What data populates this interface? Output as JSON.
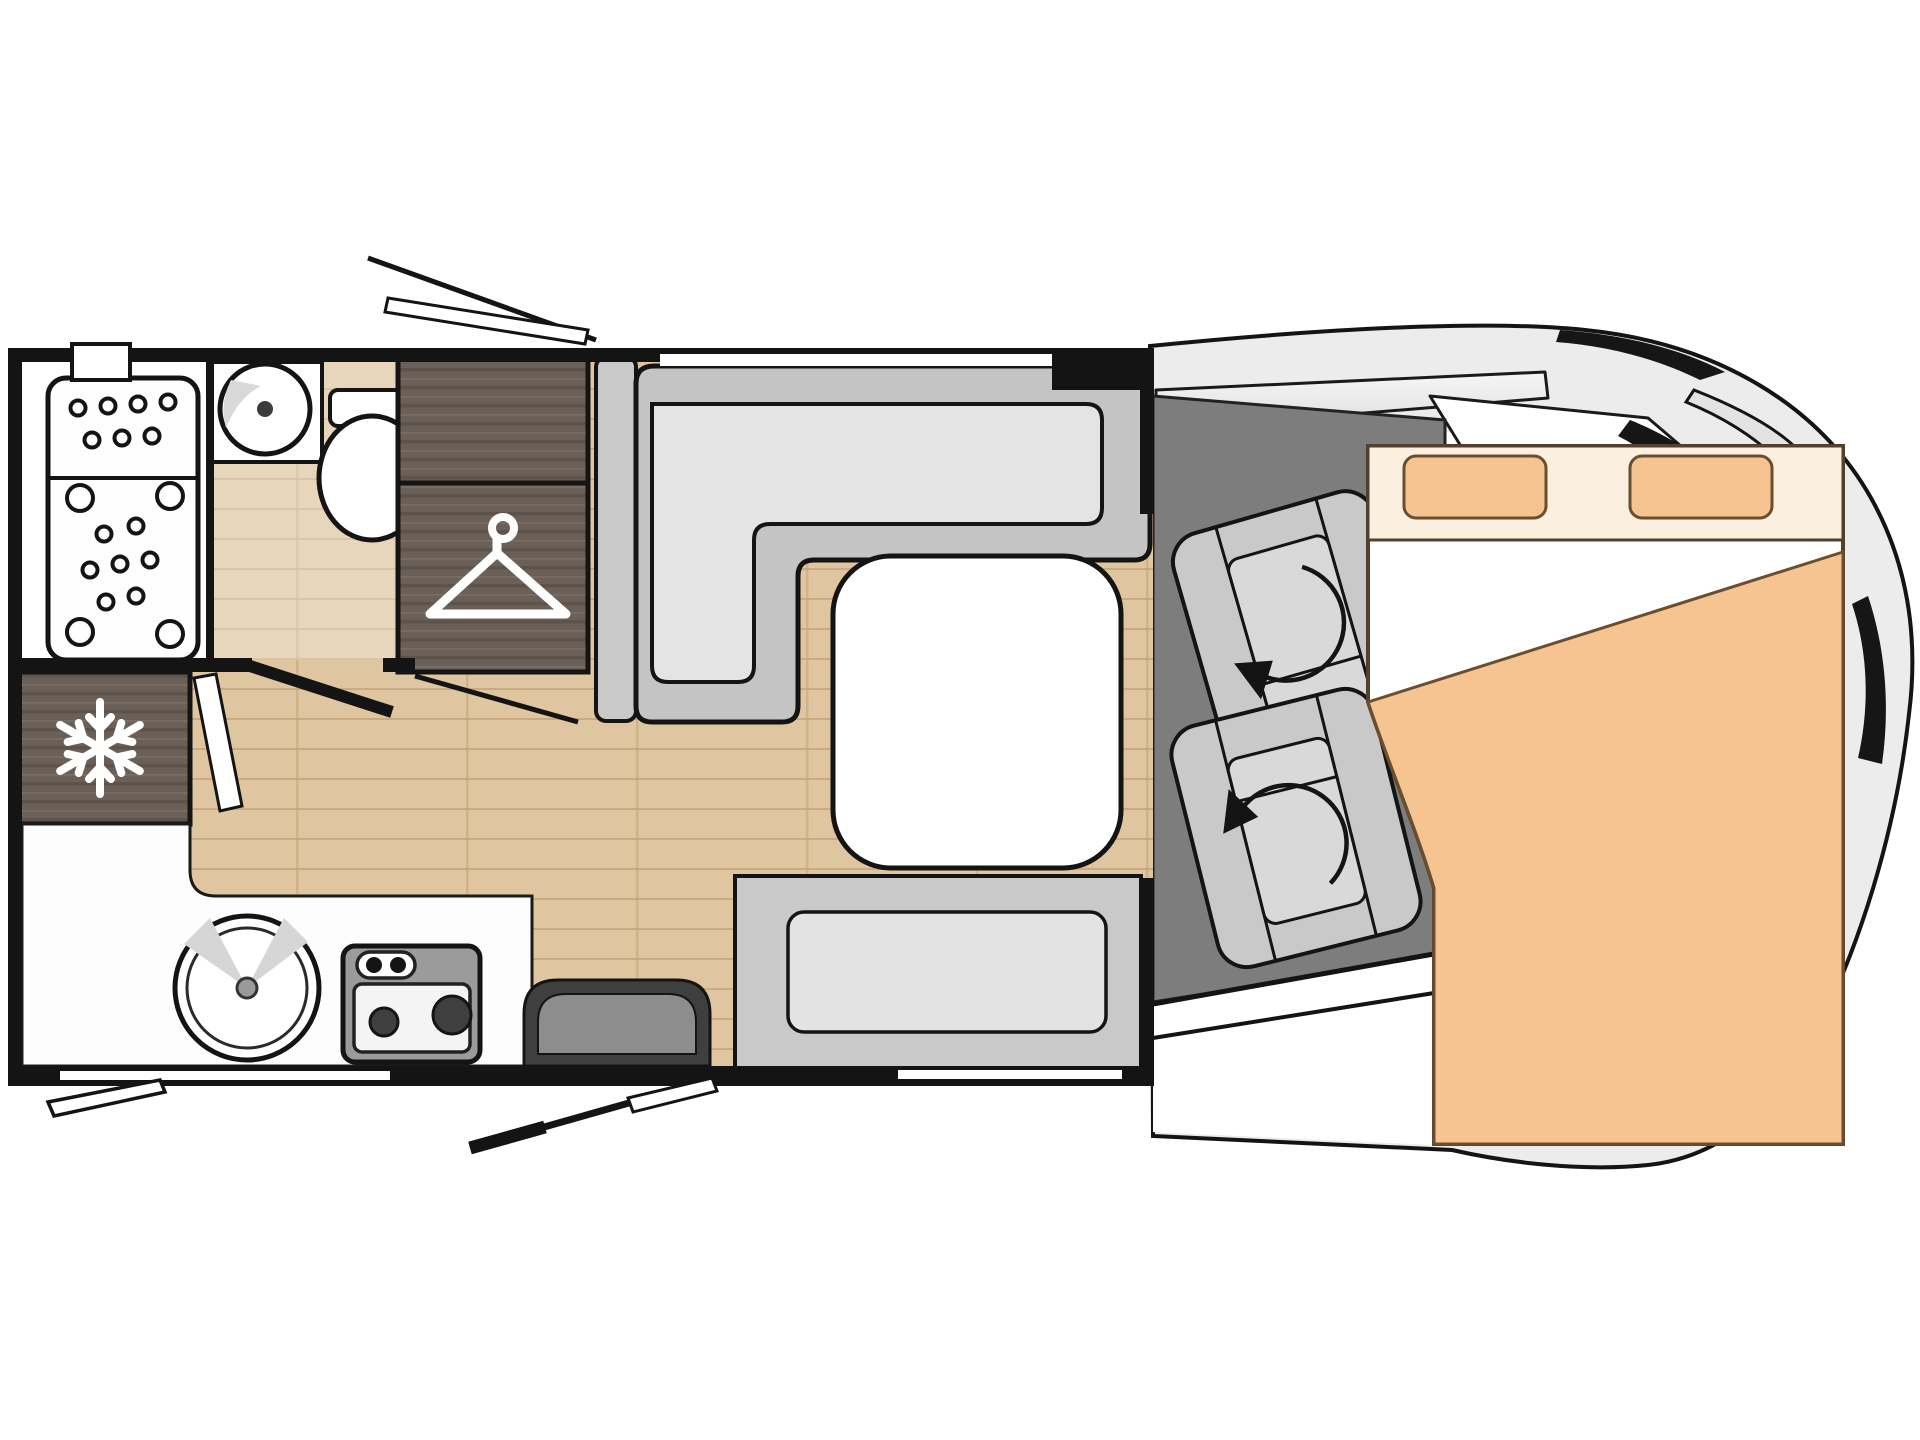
{
  "app": {
    "title": "Motorhome floor plan (top view)",
    "type": "vehicle-layout-diagram"
  },
  "colors": {
    "wall": "#141414",
    "wood_base": "#dfc5a0",
    "wood_line": "#c4a176",
    "dark_wood": "#6b6057",
    "dark_wood_grain": "#594e45",
    "sofa_outer": "#c4c4c4",
    "sofa_seat": "#e4e4e4",
    "side_panel": "#c9c9c9",
    "bench_outer": "#c9c9c9",
    "bench_seat": "#e3e3e3",
    "table": "#ffffff",
    "cab_floor": "#7d7d7d",
    "body_gray": "#ececec",
    "step_outer": "#3f3f3f",
    "step_inner": "#8d8d8d",
    "bed_base": "#fbf0e0",
    "bed_peach": "#f5c491",
    "bed_outline": "#53402c",
    "white": "#ffffff",
    "hob_body": "#9b9b9b",
    "burner": "#3f3f3f",
    "seat_gray": "#d9d9d9"
  },
  "areas": {
    "shower_room": {
      "label": "Shower room with shower tray"
    },
    "bathroom_sink": {
      "label": "Bathroom washbasin"
    },
    "toilet": {
      "label": "Toilet"
    },
    "wardrobe": {
      "label": "Wardrobe with clothes hanger symbol"
    },
    "fridge": {
      "label": "Refrigerator with snowflake symbol"
    },
    "kitchen": {
      "label": "Kitchen counter with sink and two-burner hob"
    },
    "entry_step": {
      "label": "Entrance door step"
    },
    "dinette": {
      "label": "L-shaped dinette sofa"
    },
    "table": {
      "label": "Dinette table"
    },
    "bench": {
      "label": "Bench seat"
    },
    "cab": {
      "label": "Driver cab with two swivel seats"
    },
    "seat_front": {
      "label": "Front swivel seat with rotation arrow"
    },
    "seat_rear": {
      "label": "Rear swivel seat with rotation arrow"
    },
    "bed": {
      "label": "Drop-down double bed with two pillows and duvet"
    },
    "vehicle_body": {
      "label": "Vehicle cab body outline with mirrors and windshield"
    },
    "floor": {
      "label": "Wood plank floor"
    },
    "doors": {
      "label": "Door and hatch swing indicators"
    }
  },
  "icons": {
    "snowflake": {
      "name": "snowflake-icon",
      "meaning": "refrigerator"
    },
    "hanger": {
      "name": "hanger-icon",
      "meaning": "wardrobe"
    },
    "rotation_arrow": {
      "name": "rotation-arrow-icon",
      "meaning": "swivelling cab seat"
    }
  }
}
